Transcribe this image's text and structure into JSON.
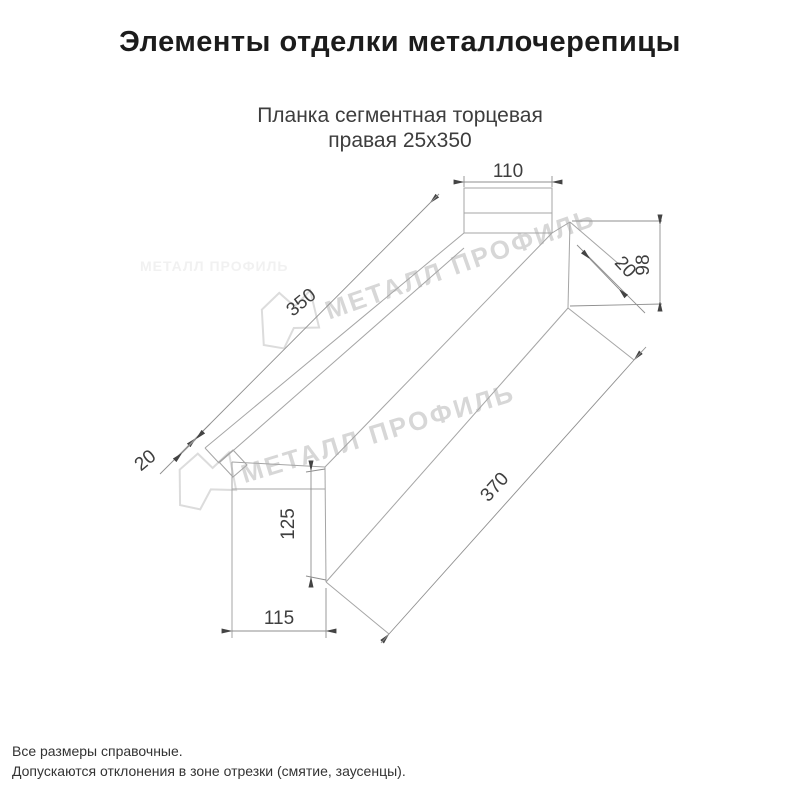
{
  "title": "Элементы отделки металлочерепицы",
  "subtitle": {
    "line1": "Планка сегментная торцевая",
    "line2": "правая 25х350"
  },
  "drawing": {
    "part_name": "Планка сегментная торцевая правая 25х350",
    "dimensions": {
      "top_width": "110",
      "length": "350",
      "hem_left": "20",
      "edge_right": "20",
      "side_height": "98",
      "bottom_length": "370",
      "end_height": "125",
      "end_width": "115"
    },
    "watermark": {
      "text": "МЕТАЛЛ ПРОФИЛЬ",
      "color": "#d7d7d7"
    }
  },
  "notes": {
    "line1": "Все размеры справочные.",
    "line2": "Допускаются отклонения в зоне отрезки (смятие, заусенцы)."
  },
  "colors": {
    "line": "#a5a5a5",
    "dim_line": "#8f8f8f",
    "dim_text": "#3f3f3f",
    "title": "#1c1c1c",
    "subtitle": "#3d3d3d",
    "background": "#ffffff"
  }
}
